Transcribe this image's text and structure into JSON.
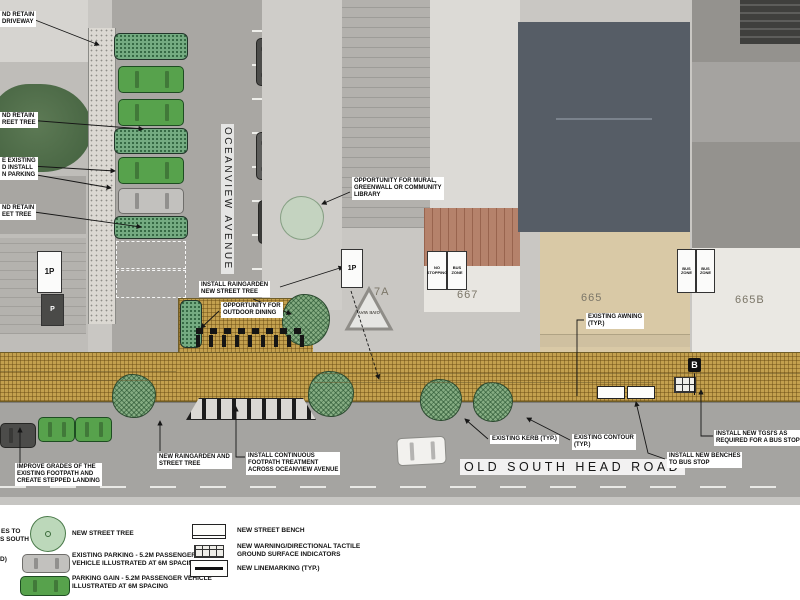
{
  "streets": {
    "vertical": "OCEANVIEW AVENUE",
    "horizontal": "OLD SOUTH HEAD ROAD"
  },
  "lots": {
    "a": "7A",
    "b": "667",
    "c": "665",
    "d": "665B"
  },
  "road_markings": {
    "give_way": "GIVE WAY",
    "bus_stop": "B"
  },
  "signs": {
    "one_p": "1P",
    "p": "P",
    "no_stopping": "NO STOPPING",
    "bus_zone": "BUS ZONE"
  },
  "edge_labels": [
    {
      "lines": [
        "ND RETAIN",
        "DRIVEWAY"
      ]
    },
    {
      "lines": [
        "ND RETAIN",
        "REET TREE"
      ]
    },
    {
      "lines": [
        "E EXISTING",
        "D INSTALL",
        "N PARKING"
      ]
    },
    {
      "lines": [
        "ND RETAIN",
        "EET TREE"
      ]
    }
  ],
  "callouts": [
    {
      "lines": [
        "INSTALL RAINGARDEN",
        "NEW STREET TREE"
      ]
    },
    {
      "lines": [
        "OPPORTUNITY FOR",
        "OUTDOOR DINING"
      ]
    },
    {
      "lines": [
        "OPPORTUNITY FOR MURAL,",
        "GREENWALL OR COMMUNITY",
        "LIBRARY"
      ]
    },
    {
      "lines": [
        "EXISTING AWNING",
        "(TYP.)"
      ]
    },
    {
      "lines": [
        "EXISTING KERB (TYP.)"
      ]
    },
    {
      "lines": [
        "EXISTING CONTOUR",
        "(TYP.)"
      ]
    },
    {
      "lines": [
        "INSTALL NEW TGSI'S AS",
        "REQUIRED FOR A BUS STOP"
      ]
    },
    {
      "lines": [
        "INSTALL NEW BENCHES",
        "TO BUS STOP"
      ]
    },
    {
      "lines": [
        "IMPROVE GRADES OF THE",
        "EXISTING FOOTPATH AND",
        "CREATE STEPPED LANDING"
      ]
    },
    {
      "lines": [
        "NEW RAINGARDEN AND",
        "STREET TREE"
      ]
    },
    {
      "lines": [
        "INSTALL CONTINUOUS",
        "FOOTPATH TREATMENT",
        "ACROSS OCEANVIEW AVENUE"
      ]
    }
  ],
  "legend": {
    "left": [
      {
        "icon": "new-street-tree",
        "lines": [
          "NEW STREET TREE"
        ]
      },
      {
        "icon": "existing-parking-car",
        "lines": [
          "EXISTING PARKING - 5.2M PASSENGER",
          "VEHICLE ILLUSTRATED AT 6M SPACING"
        ]
      },
      {
        "icon": "parking-gain-car",
        "lines": [
          "PARKING GAIN - 5.2M PASSENGER VEHICLE",
          "ILLUSTRATED AT 6M SPACING"
        ]
      }
    ],
    "right": [
      {
        "icon": "new-street-bench",
        "lines": [
          "NEW STREET BENCH"
        ]
      },
      {
        "icon": "tactile-indicators",
        "lines": [
          "NEW WARNING/DIRECTIONAL TACTILE",
          "GROUND SURFACE INDICATORS"
        ]
      },
      {
        "icon": "linemarking",
        "lines": [
          "NEW LINEMARKING (TYP.)"
        ]
      }
    ],
    "fragments": [
      "ES TO",
      "S SOUTH",
      "D)"
    ]
  },
  "colors": {
    "footpath_tan": "#c3a04e",
    "raingarden_green": "#74ab81",
    "street_tree_green": "#86ad83",
    "parking_gain_green": "#57a24c",
    "asphalt": "#a5a4a1",
    "annotation_bg": "#ffffff"
  }
}
